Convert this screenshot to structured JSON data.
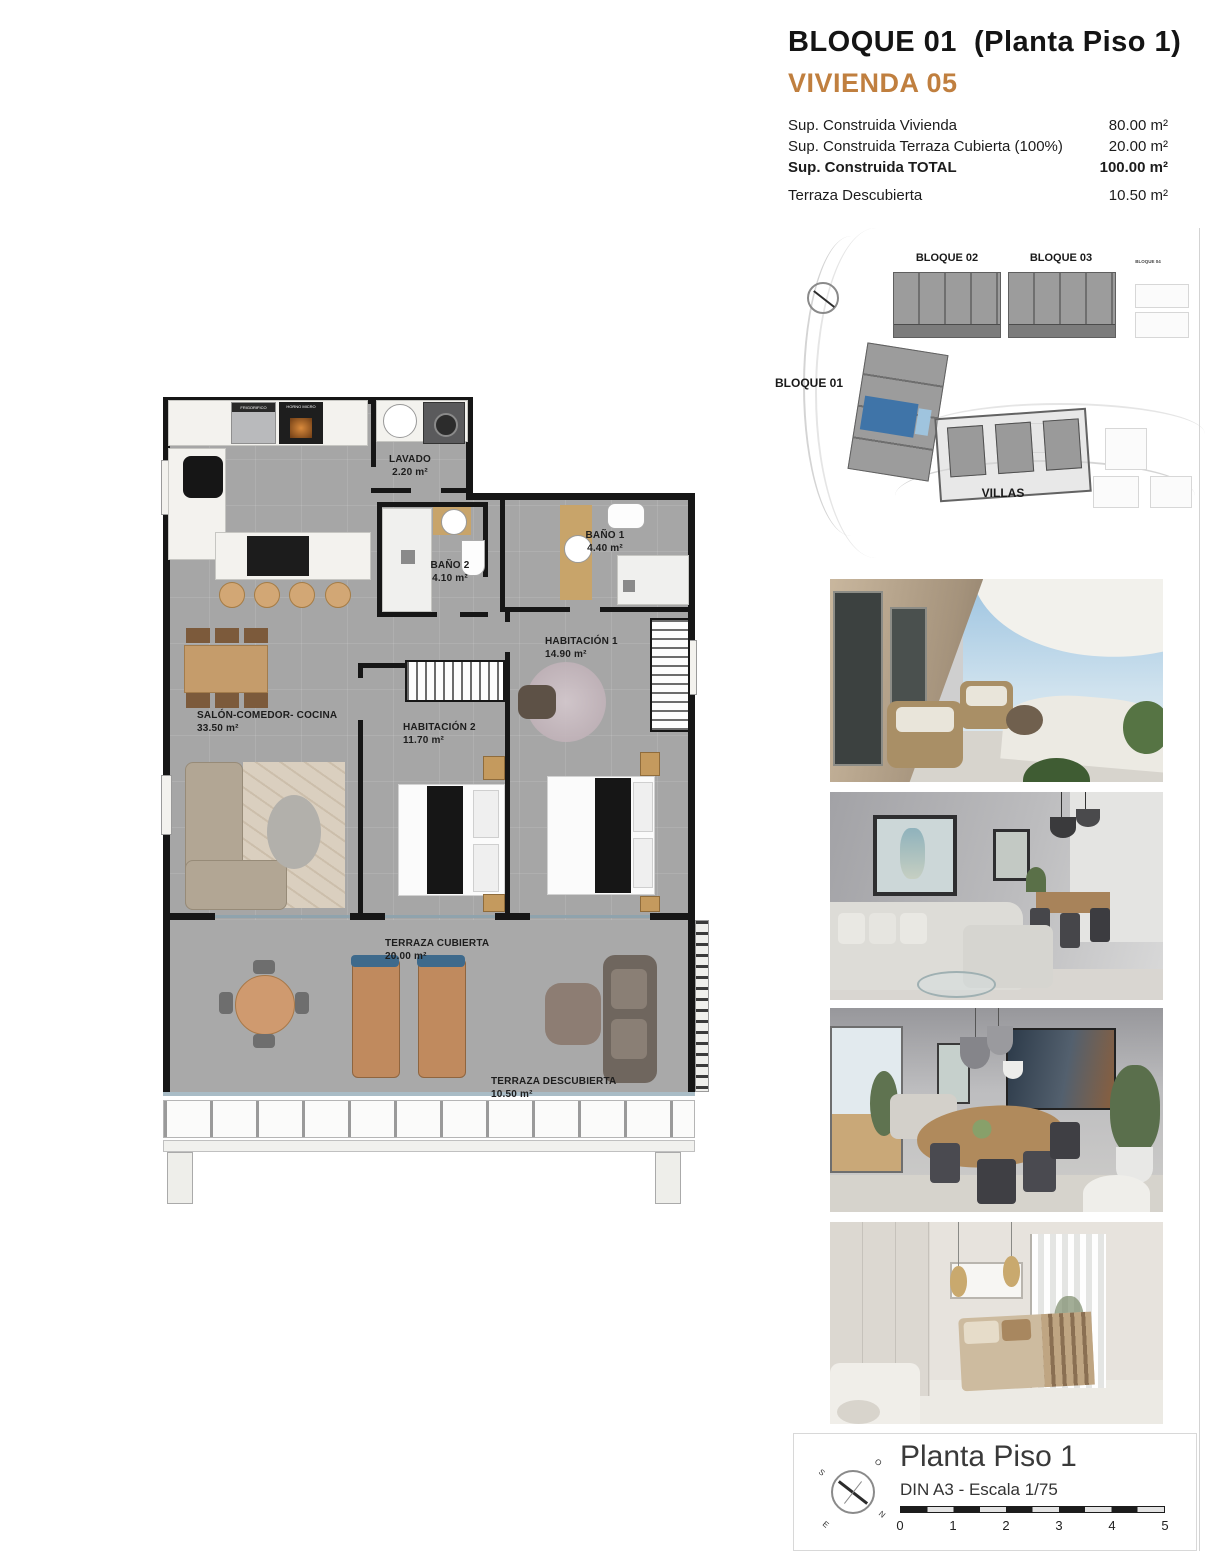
{
  "header": {
    "title": "BLOQUE 01  (Planta Piso 1)",
    "subtitle": "VIVIENDA 05",
    "accent_color": "#c07f3f",
    "rows": [
      {
        "label": "Sup. Construida Vivienda",
        "value": "80.00 m²"
      },
      {
        "label": "Sup. Construida Terraza Cubierta (100%)",
        "value": "20.00 m²"
      },
      {
        "label": "Sup. Construida TOTAL",
        "value": "100.00 m²"
      },
      {
        "label": "Terraza Descubierta",
        "value": "10.50 m²"
      }
    ]
  },
  "site_plan": {
    "bloque01": "BLOQUE 01",
    "bloque02": "BLOQUE 02",
    "bloque03": "BLOQUE 03",
    "bloque04": "BLOQUE 04",
    "villas": "VILLAS",
    "highlight_color": "#3f74a8"
  },
  "floor_plan": {
    "rooms": [
      {
        "name": "LAVADO",
        "area": "2.20 m²"
      },
      {
        "name": "BAÑO 2",
        "area": "4.10 m²"
      },
      {
        "name": "BAÑO 1",
        "area": "4.40 m²"
      },
      {
        "name": "HABITACIÓN 1",
        "area": "14.90 m²"
      },
      {
        "name": "HABITACIÓN 2",
        "area": "11.70 m²"
      },
      {
        "name": "SALÓN-COMEDOR- COCINA",
        "area": "33.50 m²"
      },
      {
        "name": "TERRAZA CUBIERTA",
        "area": "20.00 m²"
      },
      {
        "name": "TERRAZA DESCUBIERTA",
        "area": "10.50 m²"
      }
    ],
    "appliances": {
      "fridge": "FRIGORIFICO",
      "oven": "HORNO MICRO"
    }
  },
  "footer": {
    "title": "Planta Piso 1",
    "scale_note": "DIN A3 - Escala 1/75",
    "scale_ticks": [
      "0",
      "1",
      "2",
      "3",
      "4",
      "5"
    ],
    "compass": {
      "n": "N",
      "s": "S",
      "e": "E",
      "o": "O"
    }
  }
}
